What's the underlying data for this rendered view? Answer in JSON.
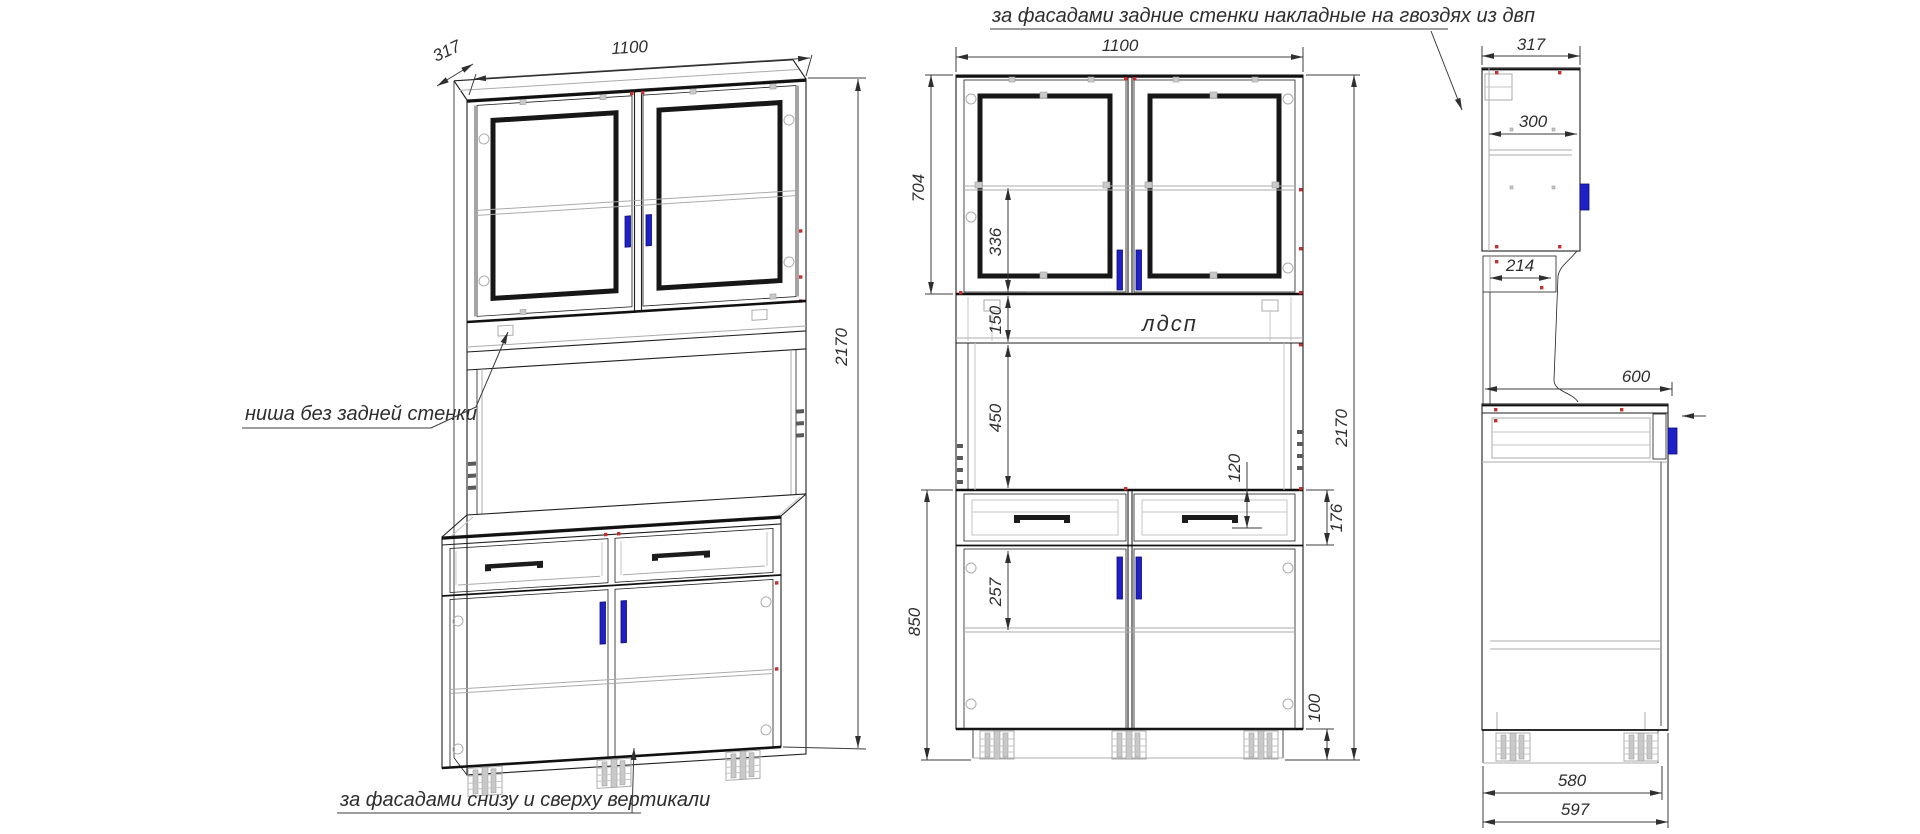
{
  "annotations": {
    "back_panels_note": "за фасадами задние стенки накладные на гвоздях из двп",
    "niche_note": "ниша без задней стенки",
    "facade_verticals_note": "за фасадами снизу и сверху вертикали",
    "material_label": "лдсп"
  },
  "views": {
    "isometric": {
      "dims": {
        "depth": "317",
        "width": "1100",
        "height": "2170"
      }
    },
    "front": {
      "dims": {
        "width": "1100",
        "upper_height": "704",
        "glass_offset": "336",
        "shelf_gap": "150",
        "niche_height": "450",
        "drawer_inner": "120",
        "drawer_front": "176",
        "base_height": "850",
        "door_offset": "257",
        "plinth": "100",
        "total_height": "2170"
      }
    },
    "side": {
      "dims": {
        "depth": "317",
        "inner_depth": "300",
        "shelf_depth": "214",
        "base_depth": "600",
        "base_inner_depth": "580",
        "base_total_depth": "597"
      }
    }
  },
  "colors": {
    "line": "#1f1f1f",
    "secondary_line": "#ababab",
    "handle": "#2020c8",
    "fastener": "#c23030",
    "text": "#2e2e2e"
  }
}
